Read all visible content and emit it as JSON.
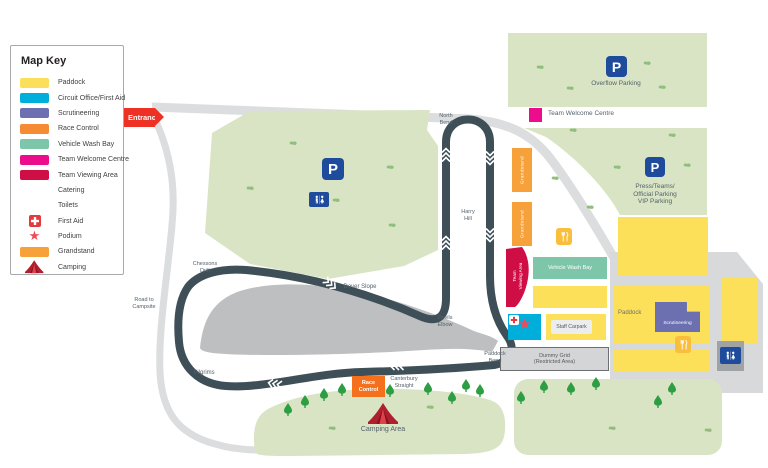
{
  "legend": {
    "title": "Map Key",
    "items": [
      {
        "label": "Paddock",
        "kind": "swatch",
        "color": "#FBDF5A"
      },
      {
        "label": "Circuit Office/First Aid",
        "kind": "swatch",
        "color": "#00AEDC"
      },
      {
        "label": "Scrutineering",
        "kind": "swatch",
        "color": "#6C70B0"
      },
      {
        "label": "Race Control",
        "kind": "swatch",
        "color": "#F58B33"
      },
      {
        "label": "Vehicle Wash Bay",
        "kind": "swatch",
        "color": "#7EC6A9"
      },
      {
        "label": "Team Welcome Centre",
        "kind": "swatch",
        "color": "#EB0D8C"
      },
      {
        "label": "Team Viewing Area",
        "kind": "swatch",
        "color": "#CE0E45"
      },
      {
        "label": "Catering",
        "kind": "icon",
        "icon": "catering-icon"
      },
      {
        "label": "Toilets",
        "kind": "icon",
        "icon": "toilets-icon"
      },
      {
        "label": "First Aid",
        "kind": "icon",
        "icon": "first-aid-icon"
      },
      {
        "label": "Podium",
        "kind": "icon",
        "icon": "podium-icon"
      },
      {
        "label": "Grandstand",
        "kind": "swatch",
        "color": "#F6A13A"
      },
      {
        "label": "Camping",
        "kind": "icon",
        "icon": "camping-icon"
      }
    ]
  },
  "entrance_label": "Entrance",
  "icons": {
    "parking": "P"
  },
  "parking": {
    "overflow_label": "Overflow Parking",
    "press_lines": [
      "Press/Teams/",
      "Official Parking",
      "VIP Parking"
    ]
  },
  "facilities": {
    "team_welcome_centre": "Team Welcome Centre",
    "vehicle_wash_bay": "Vehicle Wash Bay",
    "team_viewing_lines": [
      "Team",
      "Viewing Area"
    ],
    "staff_carpark": "Staff Carpark",
    "paddock": "Paddock",
    "scrutineering": "Scrutineering",
    "dummy_grid_lines": [
      "Dummy Grid",
      "(Restricted Area)"
    ],
    "race_control_lines": [
      "Race",
      "Control"
    ],
    "grandstand": "Grandstand",
    "camping_area": "Camping Area"
  },
  "track_labels": {
    "north_bend_lines": [
      "North",
      "Bend"
    ],
    "harry_hill_lines": [
      "Harry",
      "Hill"
    ],
    "devils_elbow_lines": [
      "Devils",
      "Elbow"
    ],
    "dover_slope": "Dover Slope",
    "chessons_drift_lines": [
      "Chessons",
      "Drift"
    ],
    "pilgrims": "Pilgrims",
    "canterbury_straight_lines": [
      "Canterbury",
      "Straight"
    ],
    "paddock_bend_lines": [
      "Paddock",
      "Bend"
    ],
    "road_to_campsite_lines": [
      "Road to",
      "Campsite"
    ]
  },
  "colors": {
    "track": "#3E4F58",
    "road": "#DCDDDE",
    "grass": "#D9E4C4",
    "paddock_yellow": "#FCE05A",
    "grandstand_orange": "#F6A13A",
    "plaza_gray": "#D8D9DA",
    "infield_gray": "#BDBFC1",
    "entrance_red": "#EE3124",
    "magenta": "#EB0D8C",
    "crimson": "#CE0E45",
    "teal": "#7EC6A9",
    "cyan": "#00AEDC",
    "purple": "#6C70B0",
    "sign_blue": "#1E4B9B"
  }
}
